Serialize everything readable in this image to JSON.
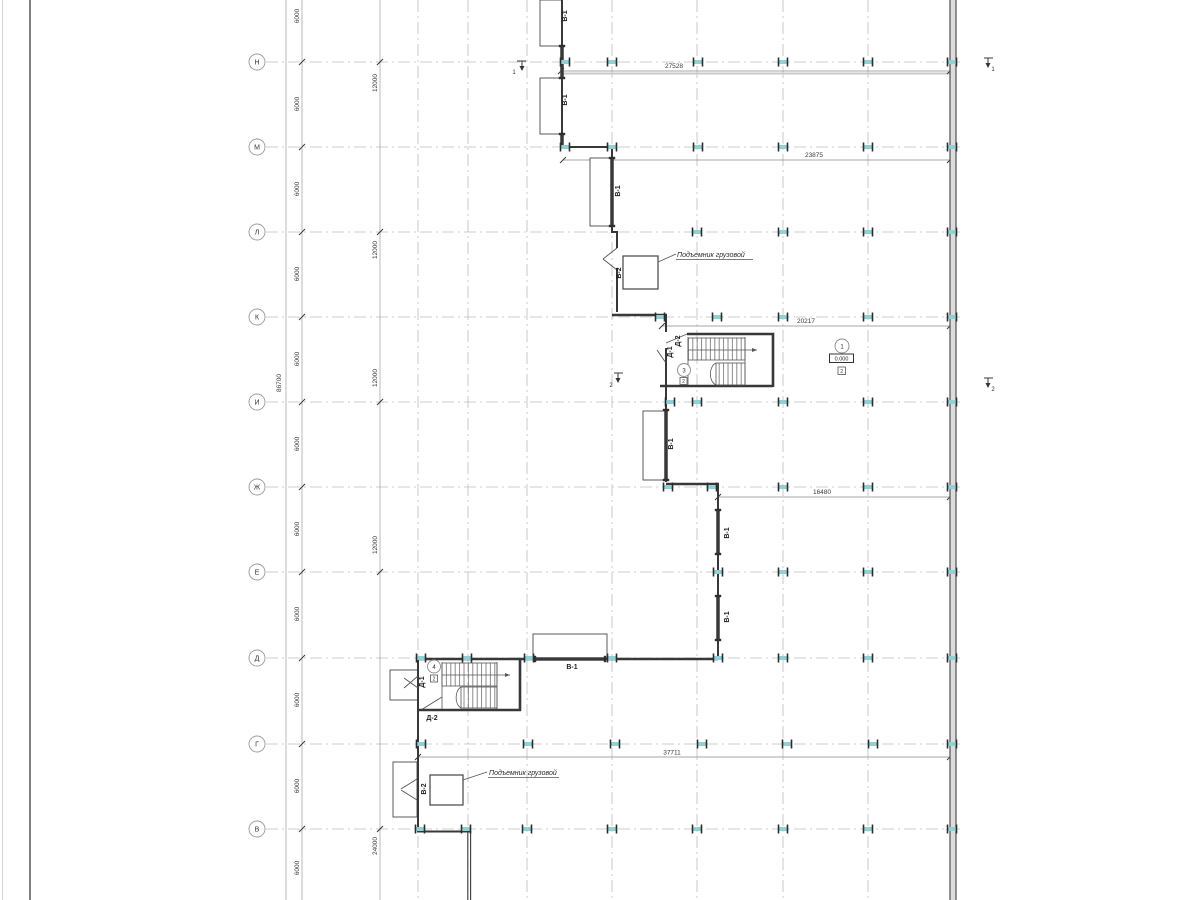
{
  "axes": {
    "rows": [
      {
        "label": "Н"
      },
      {
        "label": "М"
      },
      {
        "label": "Л"
      },
      {
        "label": "К"
      },
      {
        "label": "И"
      },
      {
        "label": "Ж"
      },
      {
        "label": "Е"
      },
      {
        "label": "Д"
      },
      {
        "label": "Г"
      },
      {
        "label": "В"
      }
    ]
  },
  "dims": {
    "total_v": "86700",
    "bay": "6000",
    "double_bay": "12000",
    "quad_bay": "24000",
    "h": [
      {
        "label": "27528"
      },
      {
        "label": "23875"
      },
      {
        "label": "20217"
      },
      {
        "label": "16480"
      },
      {
        "label": "37711"
      }
    ]
  },
  "labels": {
    "window": "В-1",
    "lift_shaft": "В-2",
    "door_main": "Д-1",
    "door_second": "Д-2",
    "lift_note": "Подъемник грузовой",
    "elevation": "0.000"
  },
  "markers": {
    "room_1": "1",
    "room_3": "3",
    "room_4": "4",
    "floor_mark": "2",
    "section_1": "1",
    "section_2": "2"
  }
}
